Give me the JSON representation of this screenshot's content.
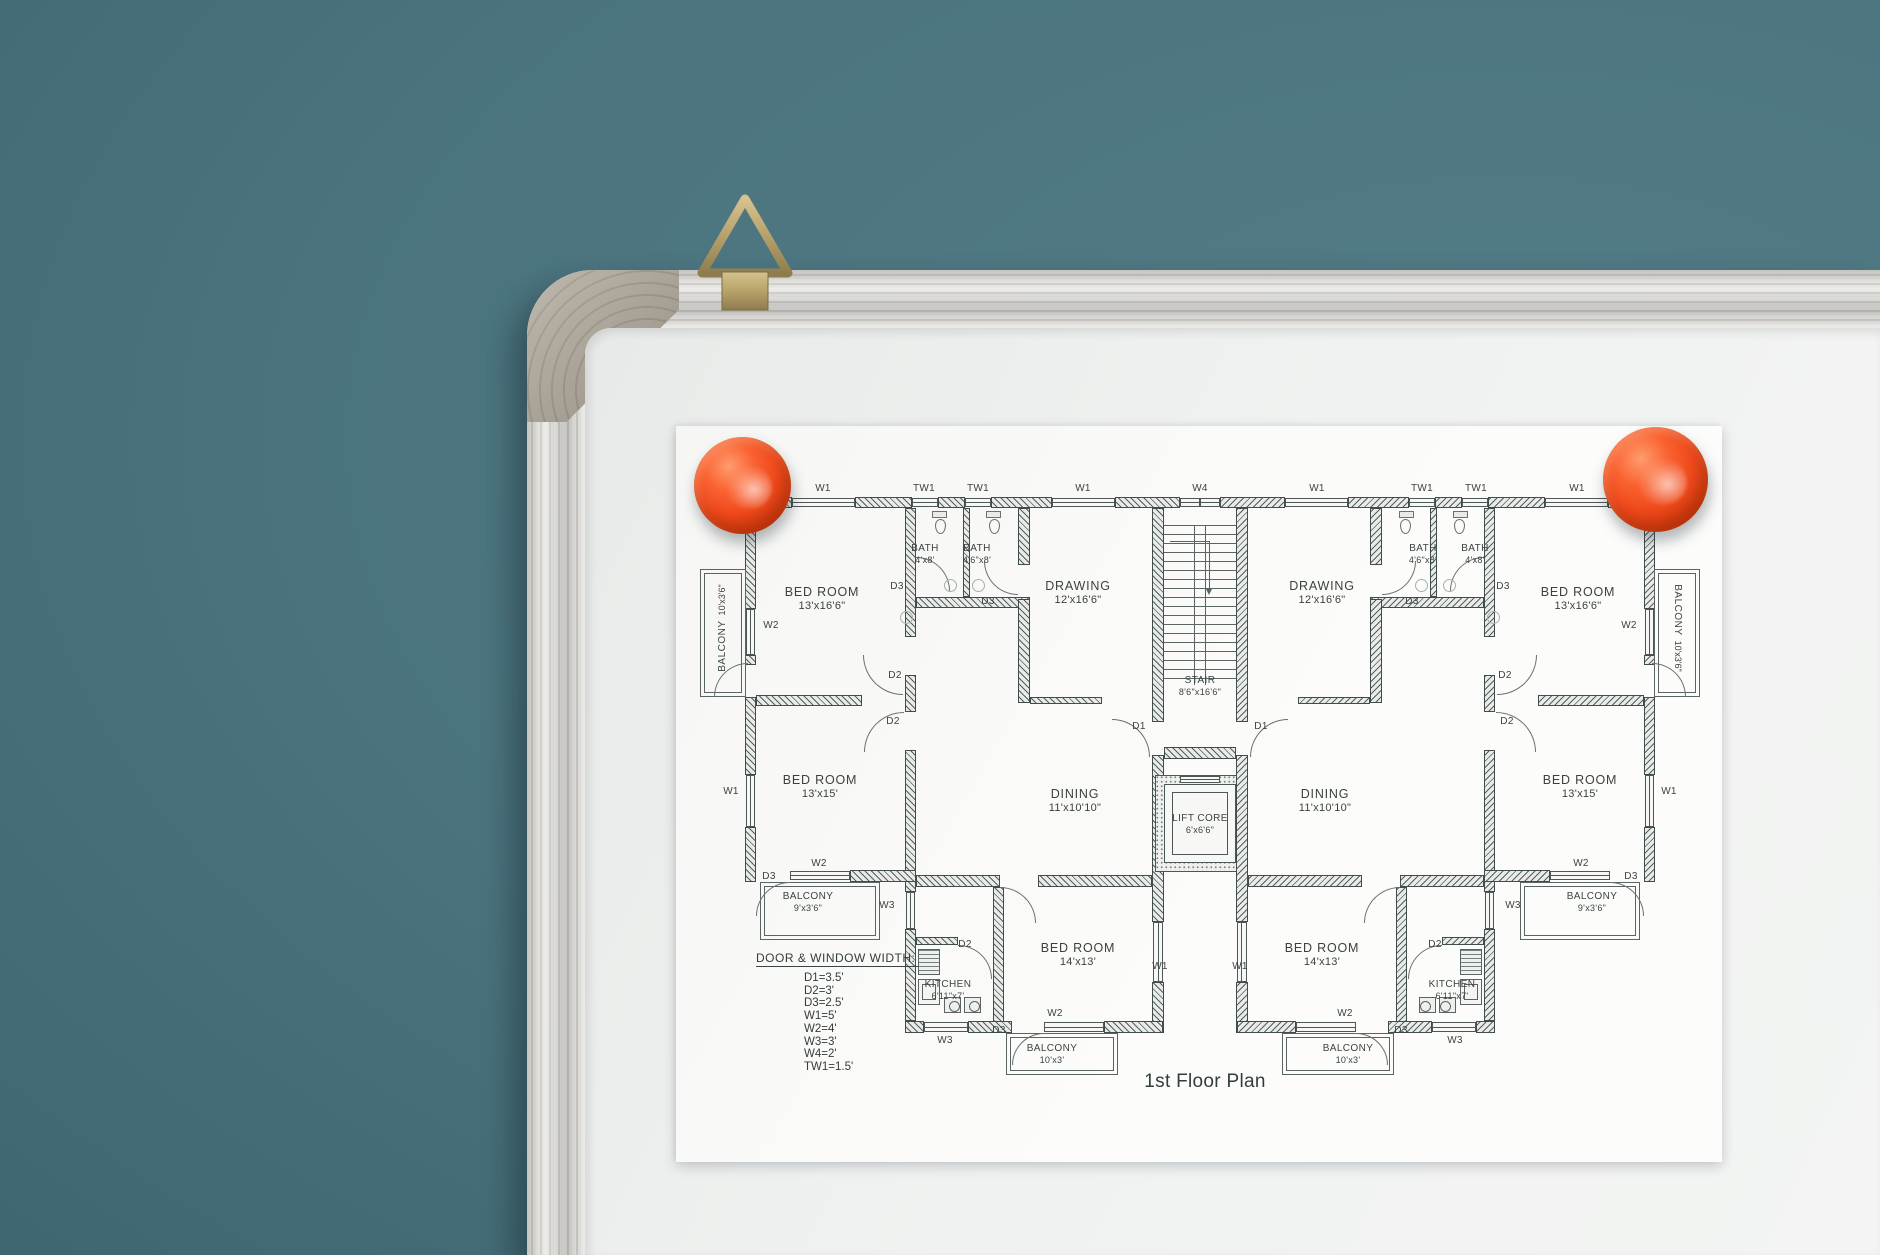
{
  "scene": {
    "wall_color": "#4a737e",
    "whiteboard_color": "#f0f2f1",
    "frame_color": "#dededa",
    "corner_cap_color": "#aaa296",
    "hook_color": "#b7a26b",
    "magnet_color": "#f04a1c",
    "paper_color": "#fafaf8",
    "ink_color": "#3a4442"
  },
  "plan": {
    "title": "1st Floor Plan",
    "legend": {
      "heading": "DOOR & WINDOW WIDTH:",
      "items": [
        "D1=3.5'",
        "D2=3'",
        "D3=2.5'",
        "W1=5'",
        "W2=4'",
        "W3=3'",
        "W4=2'",
        "TW1=1.5'"
      ]
    },
    "labels": {
      "d1": "D1",
      "d2": "D2",
      "d3": "D3",
      "w1": "W1",
      "w2": "W2",
      "w3": "W3",
      "w4": "W4",
      "tw1": "TW1"
    },
    "rooms": {
      "bedroom_large": {
        "name": "BED ROOM",
        "dims": "13'x16'6\""
      },
      "bedroom_mid": {
        "name": "BED ROOM",
        "dims": "13'x15'"
      },
      "bedroom_small": {
        "name": "BED ROOM",
        "dims": "14'x13'"
      },
      "bath_a": {
        "name": "BATH",
        "dims": "4'x8'"
      },
      "bath_b": {
        "name": "BATH",
        "dims": "4'6\"x8'"
      },
      "drawing": {
        "name": "DRAWING",
        "dims": "12'x16'6\""
      },
      "dining": {
        "name": "DINING",
        "dims": "11'x10'10\""
      },
      "kitchen": {
        "name": "KITCHEN",
        "dims": "6'11\"x7'"
      },
      "stair": {
        "name": "STAIR",
        "dims": "8'6\"x16'6\""
      },
      "lift": {
        "name": "LIFT CORE",
        "dims": "6'x6'6\""
      },
      "balcony_side": {
        "name": "BALCONY",
        "dims": "10'x3'6\""
      },
      "balcony_mid": {
        "name": "BALCONY",
        "dims": "9'x3'6\""
      },
      "balcony_bottom": {
        "name": "BALCONY",
        "dims": "10'x3'"
      }
    }
  }
}
